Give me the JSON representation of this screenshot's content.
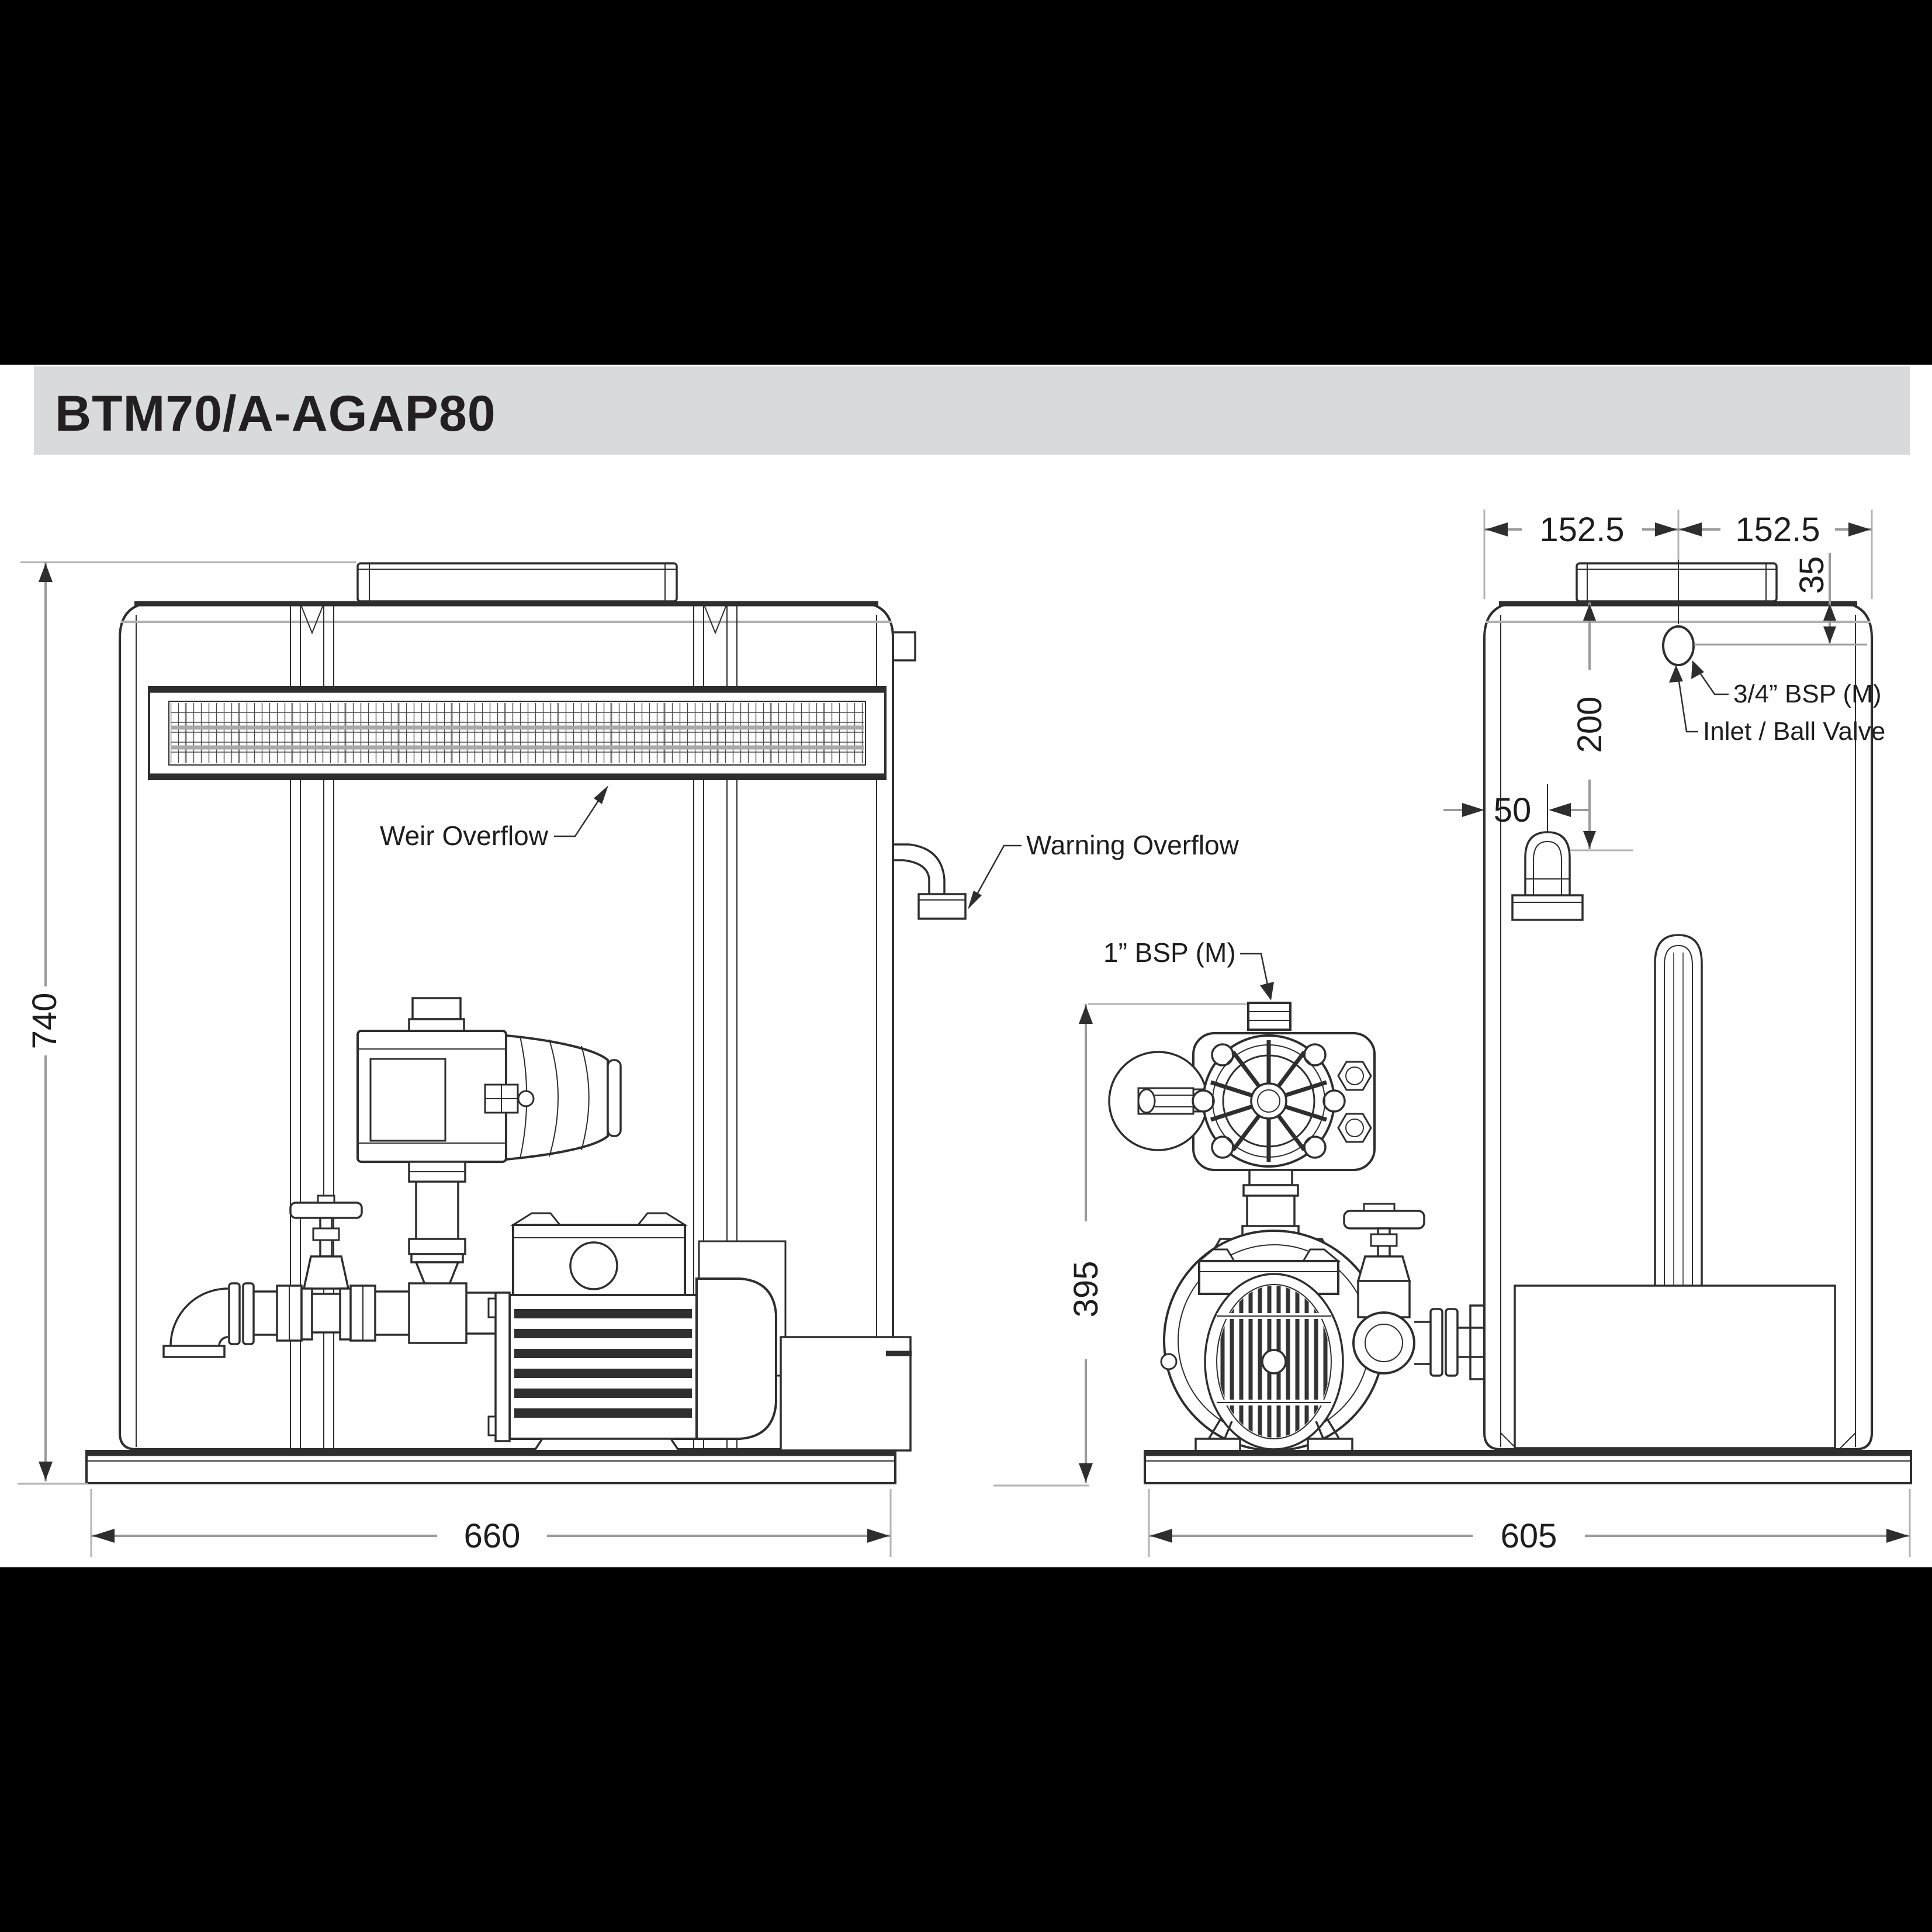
{
  "header": {
    "title": "BTM70/A-AGAP80"
  },
  "colors": {
    "band": "#000000",
    "titlebar_bg": "#d9dadb",
    "title_text": "#231f20",
    "line": "#2e2e2e",
    "dim_line": "#9b9b9b",
    "mesh_gray": "#a8a8a8"
  },
  "front": {
    "dim_height": "740",
    "dim_width": "660",
    "weir_label": "Weir Overflow",
    "warning_label": "Warning Overflow"
  },
  "pump": {
    "dim_height": "395",
    "outlet_label": "1” BSP (M)"
  },
  "side": {
    "dim_width": "605",
    "dim_lid_left": "152.5",
    "dim_lid_right": "152.5",
    "dim_inlet_offset": "35",
    "dim_inlet_drop": "200",
    "dim_overflow_offset": "50",
    "inlet_thread_label": "3/4” BSP (M)",
    "inlet_valve_label": "Inlet / Ball Valve"
  }
}
